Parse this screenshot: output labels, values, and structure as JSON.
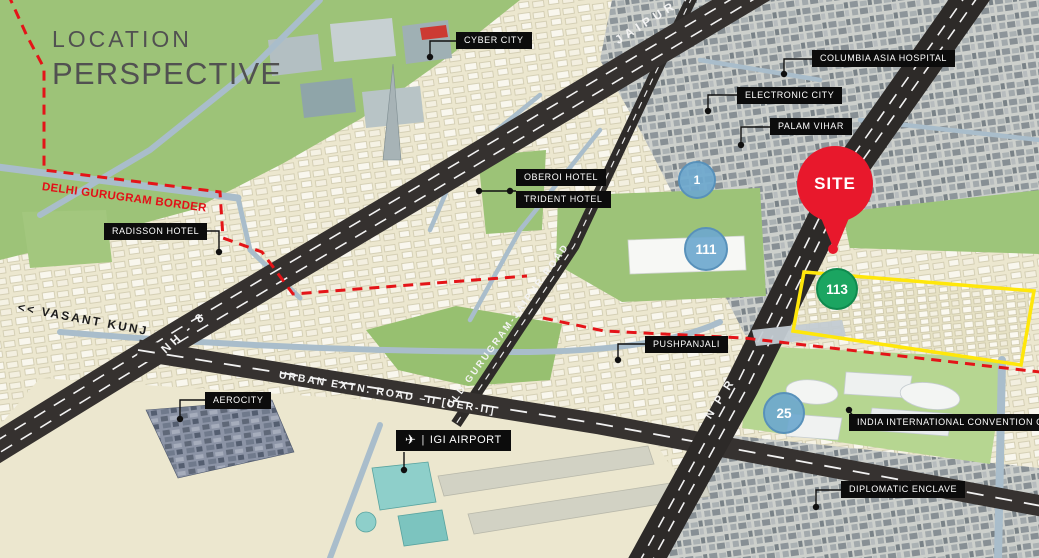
{
  "title": {
    "line1": "LOCATION",
    "line2": "PERSPECTIVE"
  },
  "annotations": {
    "border": "DELHI GURUGRAM BORDER"
  },
  "places": {
    "cyber_city": "CYBER CITY",
    "columbia_asia_hospital": "COLUMBIA ASIA HOSPITAL",
    "electronic_city": "ELECTRONIC CITY",
    "palam_vihar": "PALAM VIHAR",
    "oberoi_hotel": "OBEROI HOTEL",
    "trident_hotel": "TRIDENT HOTEL",
    "radisson_hotel": "RADISSON HOTEL",
    "pushpanjali": "PUSHPANJALI",
    "aerocity": "AEROCITY",
    "igi_airport": "IGI AIRPORT",
    "convention_centre": "INDIA INTERNATIONAL CONVENTION CENTRE",
    "diplomatic_enclave": "DIPLOMATIC ENCLAVE"
  },
  "roads": {
    "jaipur": "JAIPUR >>",
    "nh8": "NH - 8",
    "uer2": "URBAN EXTN. ROAD –II [UER-II]",
    "npr": "N P R",
    "old_gurugram_jaipur": "OLD GURUGRAM-JAIPUR ROAD",
    "vasant_kunj": "<< VASANT KUNJ"
  },
  "markers": {
    "site": "SITE",
    "sector_1": "1",
    "sector_111": "111",
    "sector_113": "113",
    "sector_25": "25"
  },
  "icons": {
    "airplane": "✈",
    "separator": "|"
  },
  "colors": {
    "site_red": "#e8182c",
    "sector_blue": "#6ea8ce",
    "sector_green": "#1ba561",
    "border_red": "#e41418",
    "site_boundary_yellow": "#ffe70a",
    "label_bg": "#0c0c0c",
    "road_dark": "#35312f",
    "map_beige": "#ebe6cb",
    "map_green": "#9dc378"
  }
}
